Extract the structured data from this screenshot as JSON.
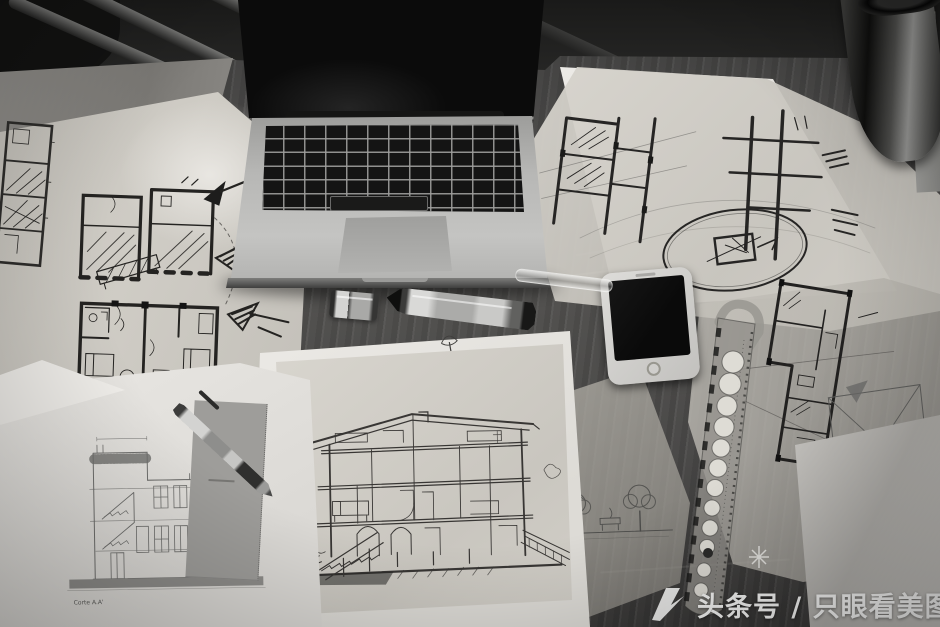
{
  "meta": {
    "type": "black-and-white photograph",
    "subject": "overhead view of an architect's desk covered with floor-plan sketches on tracing paper, a printed building section, a laptop, a smartphone, pens, a template ruler and a metal tumbler"
  },
  "watermark": {
    "text": "头条号 / 只眼看美图",
    "color": "#f3f3f2"
  },
  "papers": {
    "section_caption": "Corte A.A'"
  },
  "objects": {
    "laptop": "open laptop with black keys and trackpad, screen dark",
    "phone": "white smartphone with dark screen and home button",
    "marker": "metal marker pen with its cap lying beside it",
    "ballpoint_pen": "metal ballpoint pen lying across a printed drawing",
    "ruler": "curve template ruler with a column of round holes",
    "glass_tube": "small glass tube",
    "tumbler": "dark metal tumbler",
    "sketches": [
      "vertical floor-plan strip sketch",
      "two floor plans with arrow annotations",
      "floor-plan study with elliptical circled detail",
      "floor plan beside a roof plan with crossing diagonals",
      "hand-drawn house cross-section",
      "printed building section labelled Corte A.A'",
      "street scene with two sketched trees"
    ]
  },
  "palette": {
    "wood": "#4c4a47",
    "wood_dark": "#232322",
    "paper_white": "#eceae6",
    "tracing_paper": "#cfccc5",
    "ink": "#2b2b2b",
    "laptop_body": "#b7b7b5",
    "screen_black": "#0b0b0b",
    "watermark_white": "#f3f3f2"
  }
}
